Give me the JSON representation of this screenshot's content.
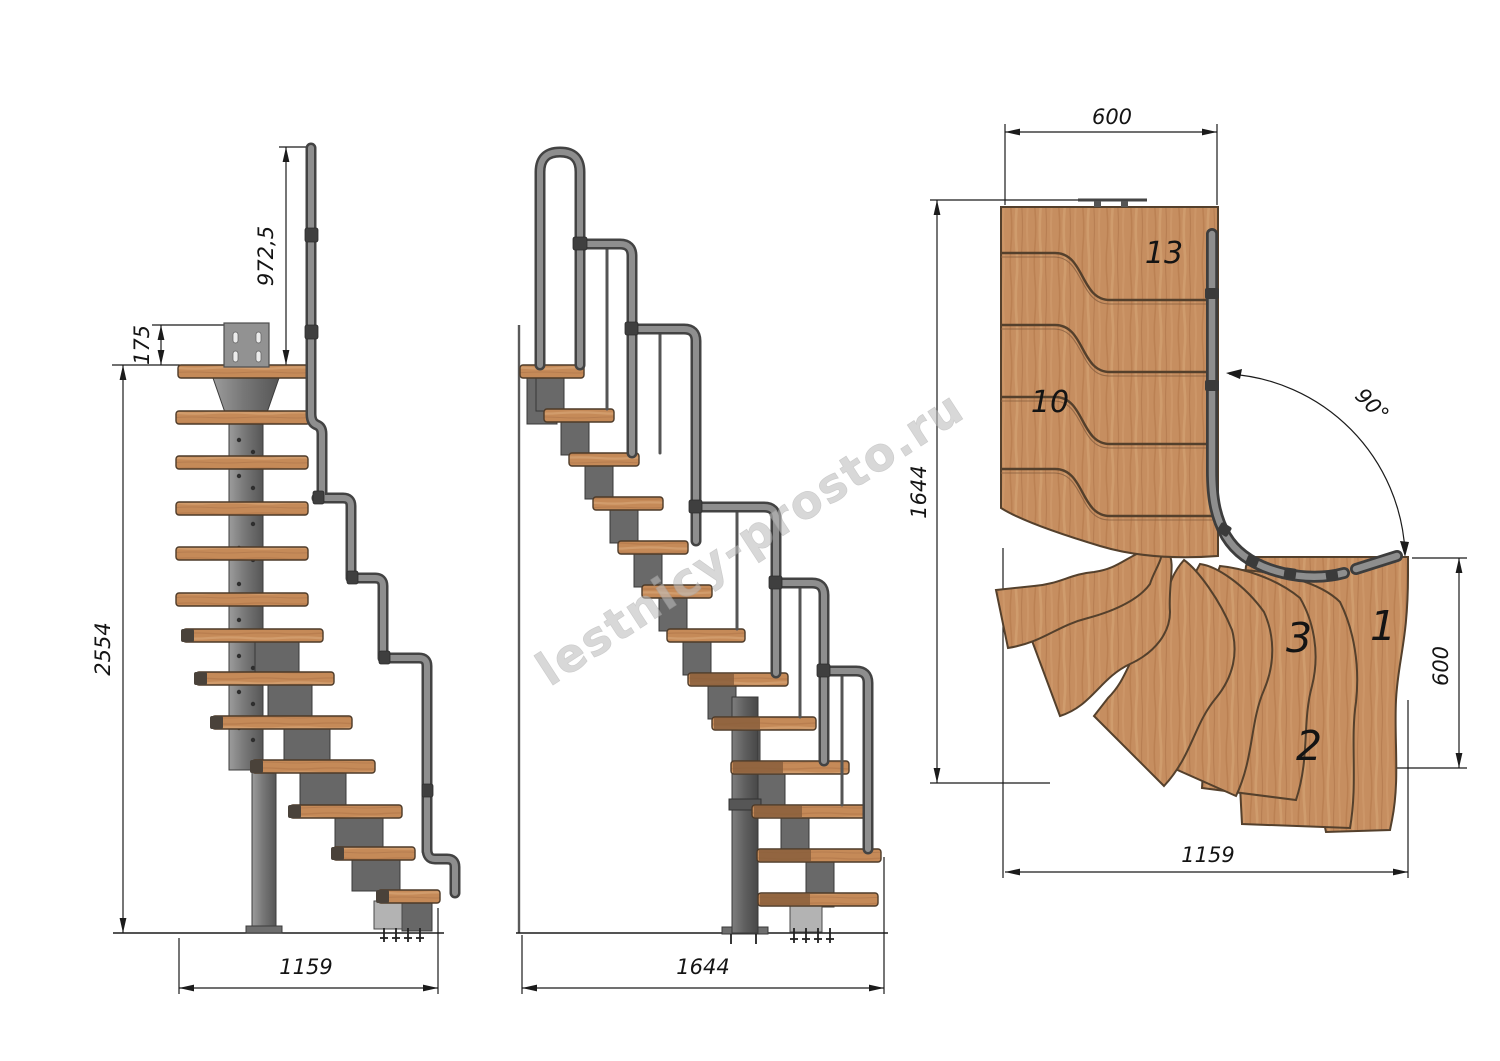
{
  "watermark": {
    "text": "lestnicy-prosto.ru"
  },
  "front_view": {
    "dim_handrail_height": "972,5",
    "dim_bracket_offset": "175",
    "dim_total_height": "2554",
    "dim_flight_width": "1159"
  },
  "side_view": {
    "dim_total_length": "1644"
  },
  "plan_view": {
    "dim_flight_top_width": "600",
    "dim_total_height": "1644",
    "dim_turn_angle": "90°",
    "dim_exit_width": "600",
    "dim_total_width": "1159",
    "steps": {
      "top": "13",
      "mid": "10",
      "three": "3",
      "one": "1",
      "two": "2"
    }
  },
  "colors": {
    "wood": "#c68e60",
    "wood_outline": "#54402c",
    "metal": "#7c7c7c",
    "metal_dark": "#434343",
    "dimension_line": "#1b1b1b",
    "watermark": "#bdbdbd"
  }
}
